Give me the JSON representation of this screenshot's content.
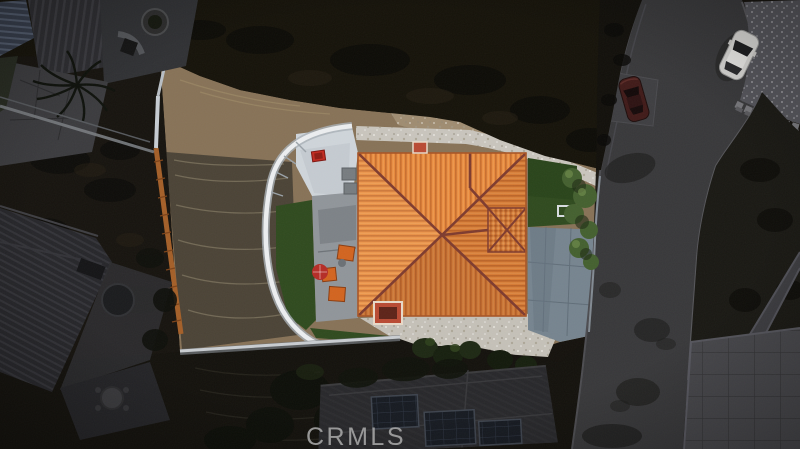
{
  "watermark": {
    "text": "CRMLS",
    "color": "#a8a8a8"
  },
  "scene": {
    "type": "aerial-photo-real-estate",
    "palette": {
      "surround_dark": "#14110c",
      "dirt_tan": "#877257",
      "dirt_dark": "#4b4336",
      "gravel_white": "#c9c5bd",
      "roof_orange": "#e8893c",
      "roof_ridge": "#7e3b2e",
      "lawn_green": "#2f4a1e",
      "concrete_pad": "#cfd5da",
      "patio_gray": "#90959a",
      "driveway_gray": "#76848f",
      "road_gray": "#38383a",
      "scored_concrete": "#46464a",
      "wall_white": "#eceef0",
      "fence_orange": "#a45f28",
      "furniture_orange": "#d2641f",
      "umbrella_red": "#b52c26",
      "wagon_red": "#c22a1f",
      "car_white": "#d6d5d2",
      "car_red": "#401a18",
      "tree_green": "#44602f"
    }
  }
}
